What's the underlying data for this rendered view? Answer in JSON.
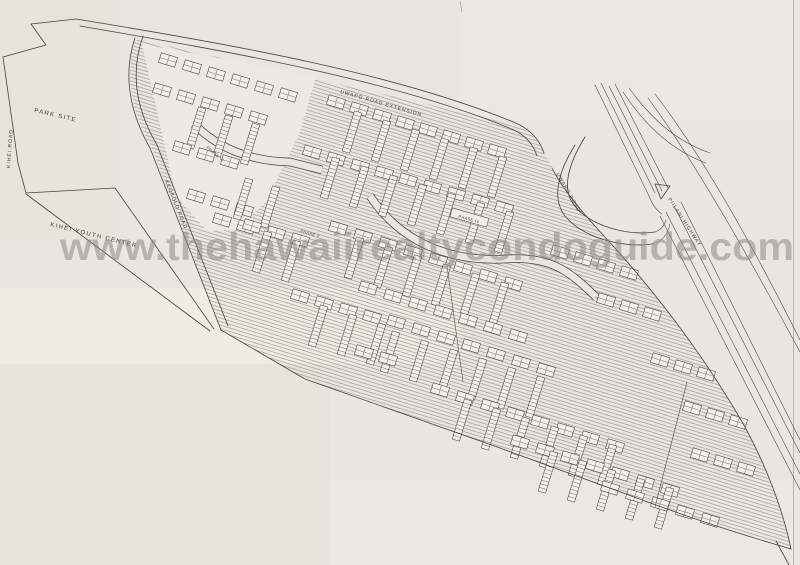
{
  "watermark": {
    "text": "www.thehawaiirealtycondoguide.com"
  },
  "labels": {
    "park_site": "PARK SITE",
    "kihei_road": "KIHEI ROAD",
    "kihei_youth_center": "KIHEI YOUTH CENTER",
    "keokolo_road": "KEOKOLO ROAD",
    "uwapo_road_extension": "UWAPO ROAD EXTENSION",
    "uwapo_road": "UWAPO ROAD",
    "piilani_highway": "PIILANI HIGHWAY",
    "phase_iv": "PHASE IV",
    "phase_v": "PHASE V",
    "phase_vi": "PHASE VI"
  },
  "colors": {
    "paper": "#e9e6e1",
    "ink": "#45423c",
    "hatch": "#97948d",
    "watermark": "#878787"
  }
}
